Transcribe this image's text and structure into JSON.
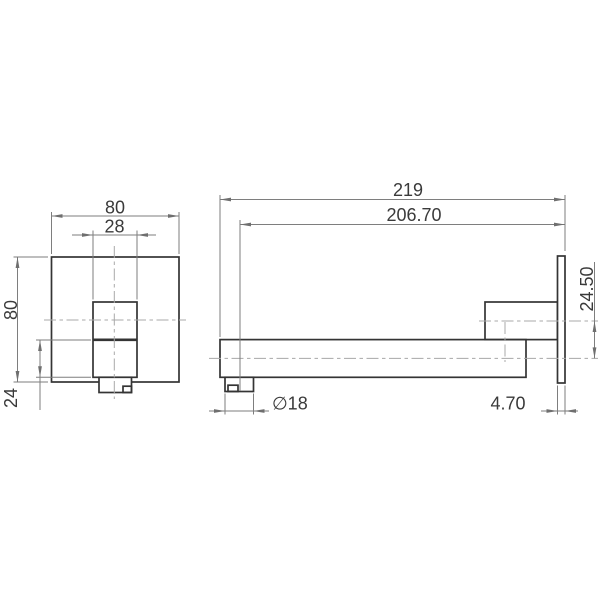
{
  "drawing": {
    "description": "Two-view technical dimension drawing of a wall-mounted mixer plate and spout",
    "colors": {
      "background": "#ffffff",
      "object_line": "#343434",
      "dimension_line": "#7e7e7e",
      "centerline": "#a8a8a8",
      "text": "#3a3a3a"
    }
  },
  "labels": {
    "front_plate_width": "80",
    "front_handle_width": "28",
    "front_plate_height": "80",
    "front_lower_section_height": "24",
    "side_overall_projection": "219",
    "side_outlet_projection": "206.70",
    "side_centreline_offset": "24.50",
    "side_spout_diameter": "∅18",
    "side_plate_thickness": "4.70"
  }
}
